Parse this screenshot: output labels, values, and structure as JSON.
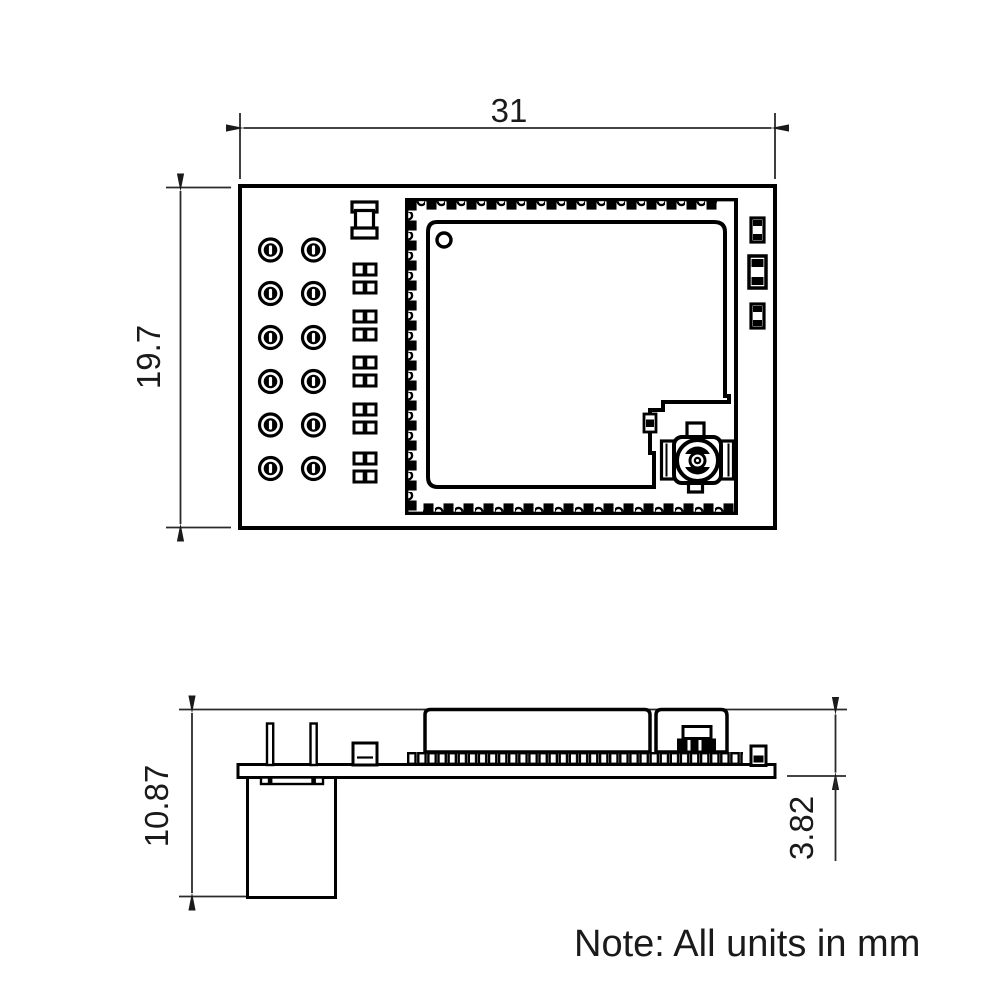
{
  "note": {
    "text": "Note: All units in mm"
  },
  "dimensions": {
    "width": {
      "label": "31",
      "value": 31,
      "unit": "mm",
      "applies_to": "top-view board width"
    },
    "height": {
      "label": "19.7",
      "value": 19.7,
      "unit": "mm",
      "applies_to": "top-view board height"
    },
    "total_height": {
      "label": "10.87",
      "value": 10.87,
      "unit": "mm",
      "applies_to": "side-view overall height"
    },
    "module_height": {
      "label": "3.82",
      "value": 3.82,
      "unit": "mm",
      "applies_to": "side-view shield top to board bottom"
    }
  },
  "colors": {
    "line": "#000000",
    "text": "#1a1a1a",
    "background": "#ffffff"
  }
}
